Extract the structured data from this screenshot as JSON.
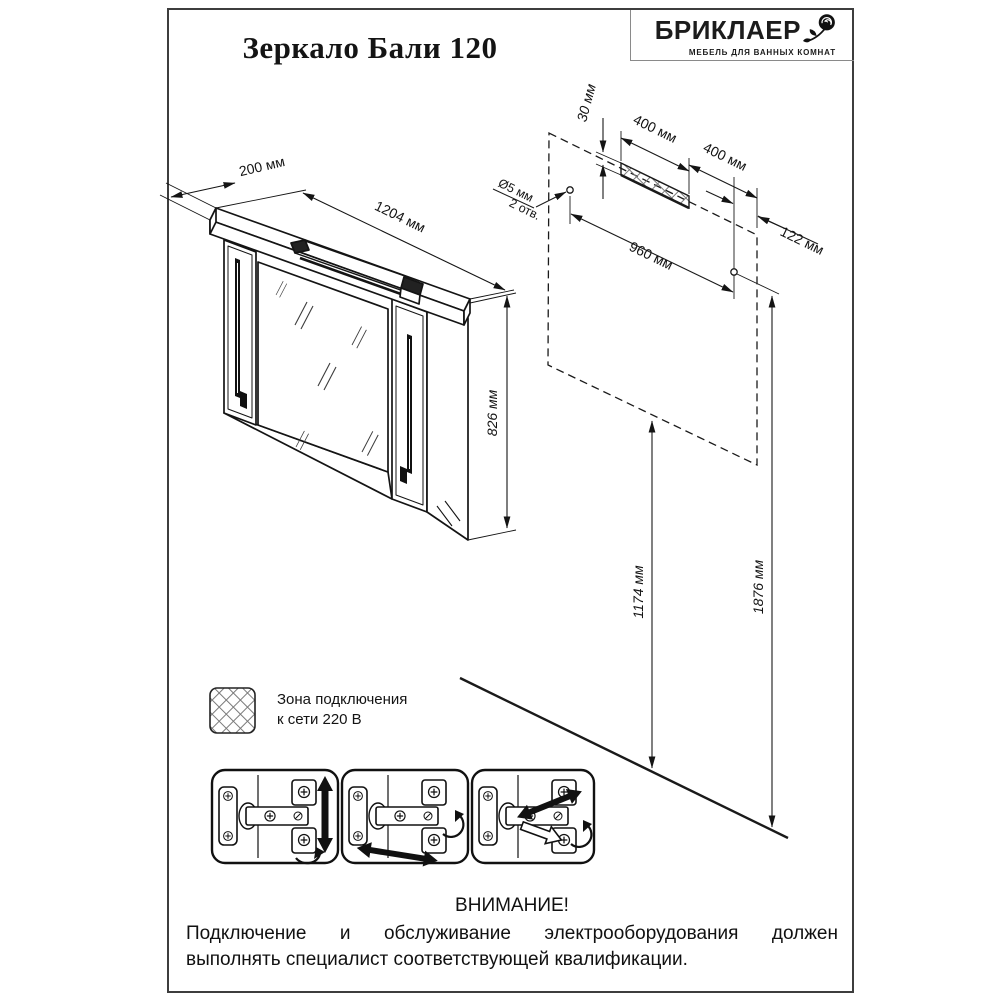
{
  "header": {
    "title": "Зеркало Бали 120",
    "brand_name": "БРИКЛАЕР",
    "brand_tagline": "МЕБЕЛЬ ДЛЯ ВАННЫХ КОМНАТ"
  },
  "dims": {
    "depth": "200 мм",
    "width": "1204 мм",
    "height": "826 мм",
    "zone_height": "30 мм",
    "zone_width": "400 мм",
    "zone_offset": "400 мм",
    "hole_dia": "Ø5 мм",
    "hole_count": "2 отв.",
    "hole_span": "960 мм",
    "hole_to_edge": "122 мм",
    "floor_to_bottom": "1174 мм",
    "floor_to_holes": "1876 мм"
  },
  "legend": {
    "line1": "Зона подключения",
    "line2": "к сети 220 В"
  },
  "warning": {
    "title": "ВНИМАНИЕ!",
    "line1": "Подключение и обслуживание электрооборудования должен",
    "line2": "выполнять специалист соответствующей квалификации."
  }
}
